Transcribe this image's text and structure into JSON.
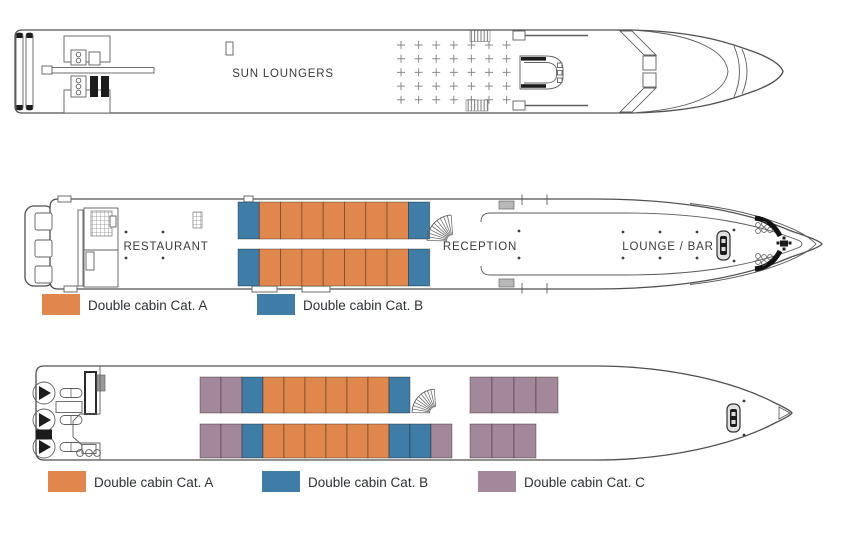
{
  "page": {
    "background": "#ffffff",
    "outline_color": "#4f4f4f",
    "text_color": "#3a3a3a"
  },
  "categories": {
    "A": {
      "label": "Double cabin Cat. A",
      "color": "#E0874E"
    },
    "B": {
      "label": "Double cabin Cat. B",
      "color": "#3F7CA6"
    },
    "C": {
      "label": "Double cabin Cat. C",
      "color": "#A3879B"
    }
  },
  "decks": {
    "sun": {
      "label": "SUN LOUNGERS",
      "loungers": {
        "rows": 5,
        "cols": 7
      }
    },
    "main": {
      "labels": {
        "restaurant": "RESTAURANT",
        "reception": "RECEPTION",
        "lounge": "LOUNGE / BAR"
      },
      "cabin_rows": [
        {
          "y": 202,
          "h": 37,
          "segments": [
            {
              "x": 238,
              "w": 21.3,
              "cabins": [
                "B",
                "A",
                "A",
                "A",
                "A",
                "A",
                "A",
                "A",
                "B"
              ]
            }
          ]
        },
        {
          "y": 249,
          "h": 37,
          "segments": [
            {
              "x": 238,
              "w": 21.3,
              "cabins": [
                "B",
                "A",
                "A",
                "A",
                "A",
                "A",
                "A",
                "A",
                "B"
              ]
            }
          ]
        }
      ]
    },
    "lower": {
      "cabin_rows": [
        {
          "y": 377,
          "h": 36,
          "segments": [
            {
              "x": 200,
              "w": 21,
              "cabins": [
                "C",
                "C",
                "B",
                "A",
                "A",
                "A",
                "A",
                "A",
                "A",
                "B"
              ]
            },
            {
              "x": 470,
              "w": 22,
              "cabins": [
                "C",
                "C",
                "C",
                "C"
              ]
            }
          ]
        },
        {
          "y": 424,
          "h": 34,
          "segments": [
            {
              "x": 200,
              "w": 21,
              "cabins": [
                "C",
                "C",
                "B",
                "A",
                "A",
                "A",
                "A",
                "A",
                "A",
                "B",
                "B",
                "C"
              ]
            },
            {
              "x": 470,
              "w": 22,
              "cabins": [
                "C",
                "C",
                "C"
              ]
            }
          ]
        }
      ]
    }
  },
  "legends": {
    "main": [
      "A",
      "B"
    ],
    "lower": [
      "A",
      "B",
      "C"
    ]
  }
}
